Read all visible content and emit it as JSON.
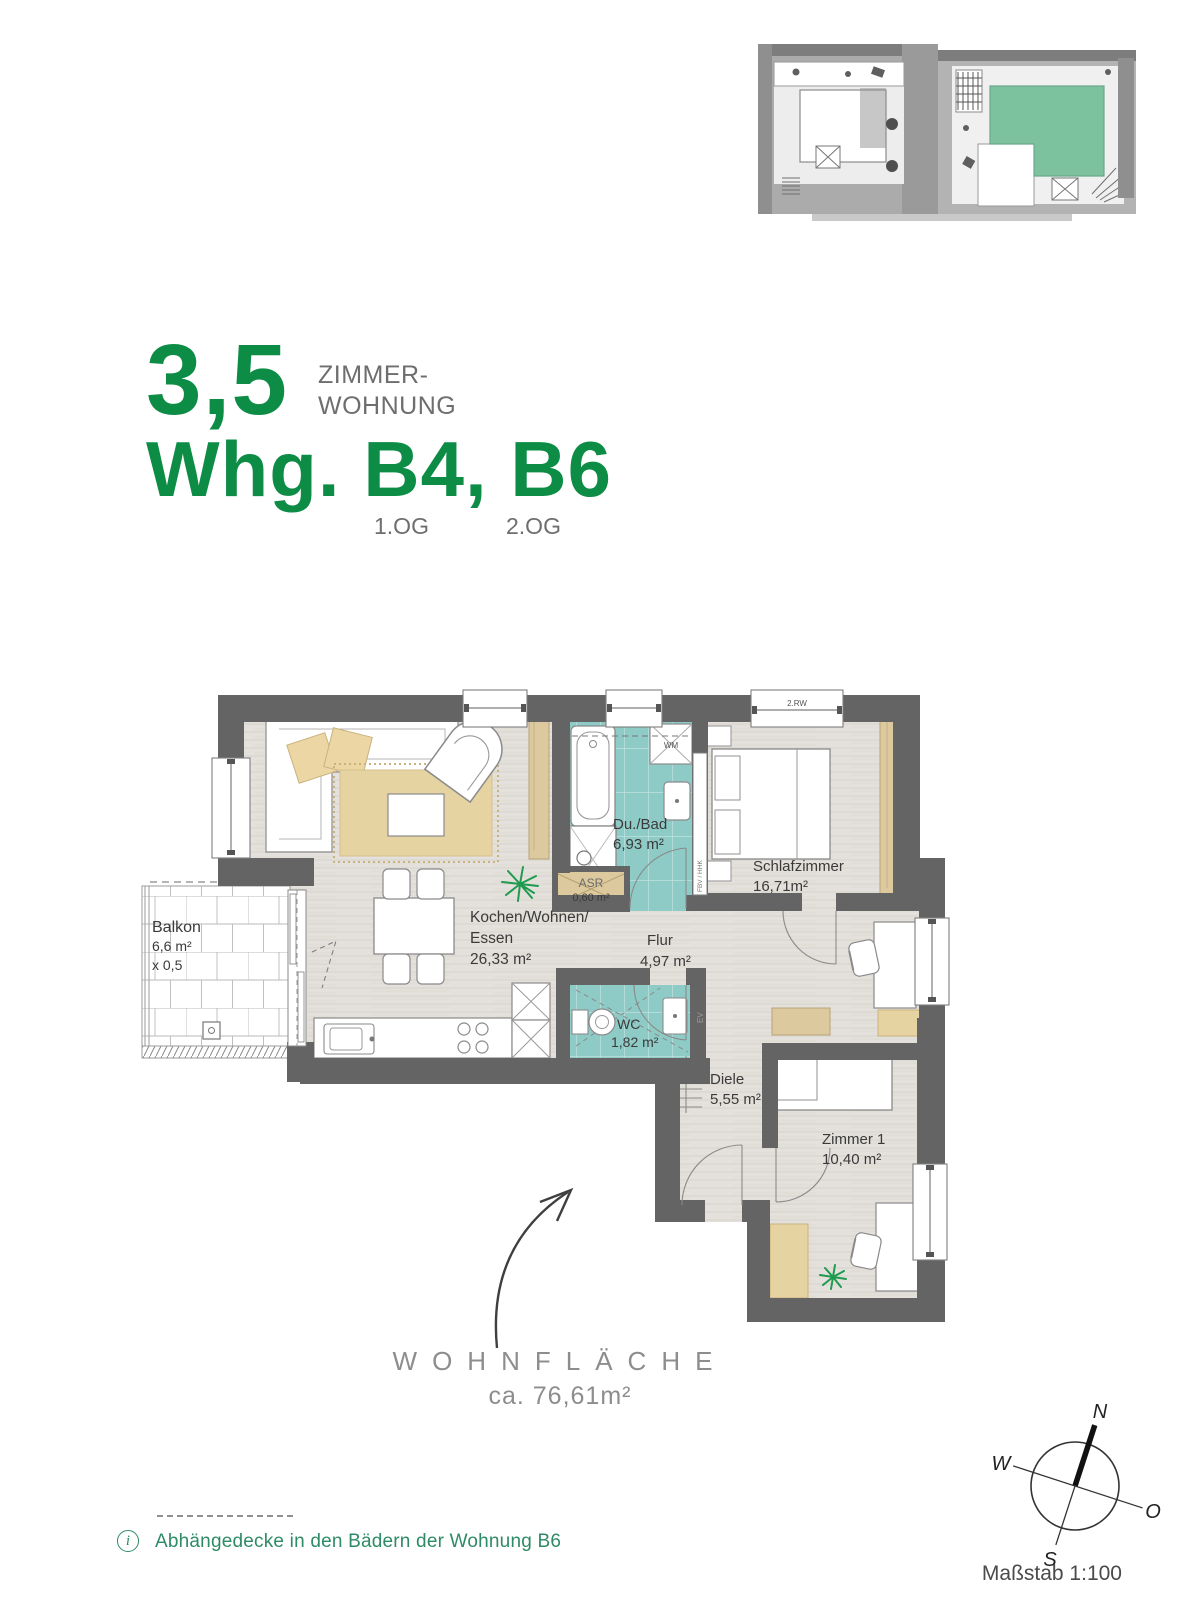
{
  "header": {
    "rooms_count": "3,5",
    "type_line1": "ZIMMER-",
    "type_line2": "WOHNUNG",
    "title": "Whg. B4, B6",
    "floor_left": "1.OG",
    "floor_right": "2.OG",
    "accent_color": "#0d8c46"
  },
  "site_plan": {
    "highlight_color": "#7cc29e"
  },
  "plan": {
    "balkon_name": "Balkon",
    "balkon_area": "6,6 m²",
    "balkon_factor": "x 0,5",
    "wohnen_line1": "Kochen/Wohnen/",
    "wohnen_line2": "Essen",
    "wohnen_area": "26,33 m²",
    "bad_name": "Du./Bad",
    "bad_area": "6,93 m²",
    "asr_name": "ASR",
    "asr_area": "0,60 m²",
    "schlaf_name": "Schlafzimmer",
    "schlaf_area": "16,71m²",
    "flur_name": "Flur",
    "flur_area": "4,97 m²",
    "wc_name": "WC",
    "wc_area": "1,82 m²",
    "diele_name": "Diele",
    "diele_area": "5,55 m²",
    "zimmer1_name": "Zimmer 1",
    "zimmer1_area": "10,40 m²",
    "tag_wm": "WM",
    "tag_rw": "2.RW",
    "tag_ev": "EV",
    "tag_shaft": "FBV / HHK",
    "wall_color": "#646464",
    "tile_color": "#8ecbc6",
    "wood_color": "#e4e1dc",
    "furniture_tan": "#e6d3a2"
  },
  "summary": {
    "label": "WOHNFLÄCHE",
    "value": "ca. 76,61m²"
  },
  "note": {
    "icon": "i",
    "text": "Abhängedecke in den Bädern der Wohnung B6"
  },
  "compass": {
    "north": "N",
    "west": "W",
    "east": "O",
    "south": "S"
  },
  "scale_label": "Maßstab 1:100"
}
